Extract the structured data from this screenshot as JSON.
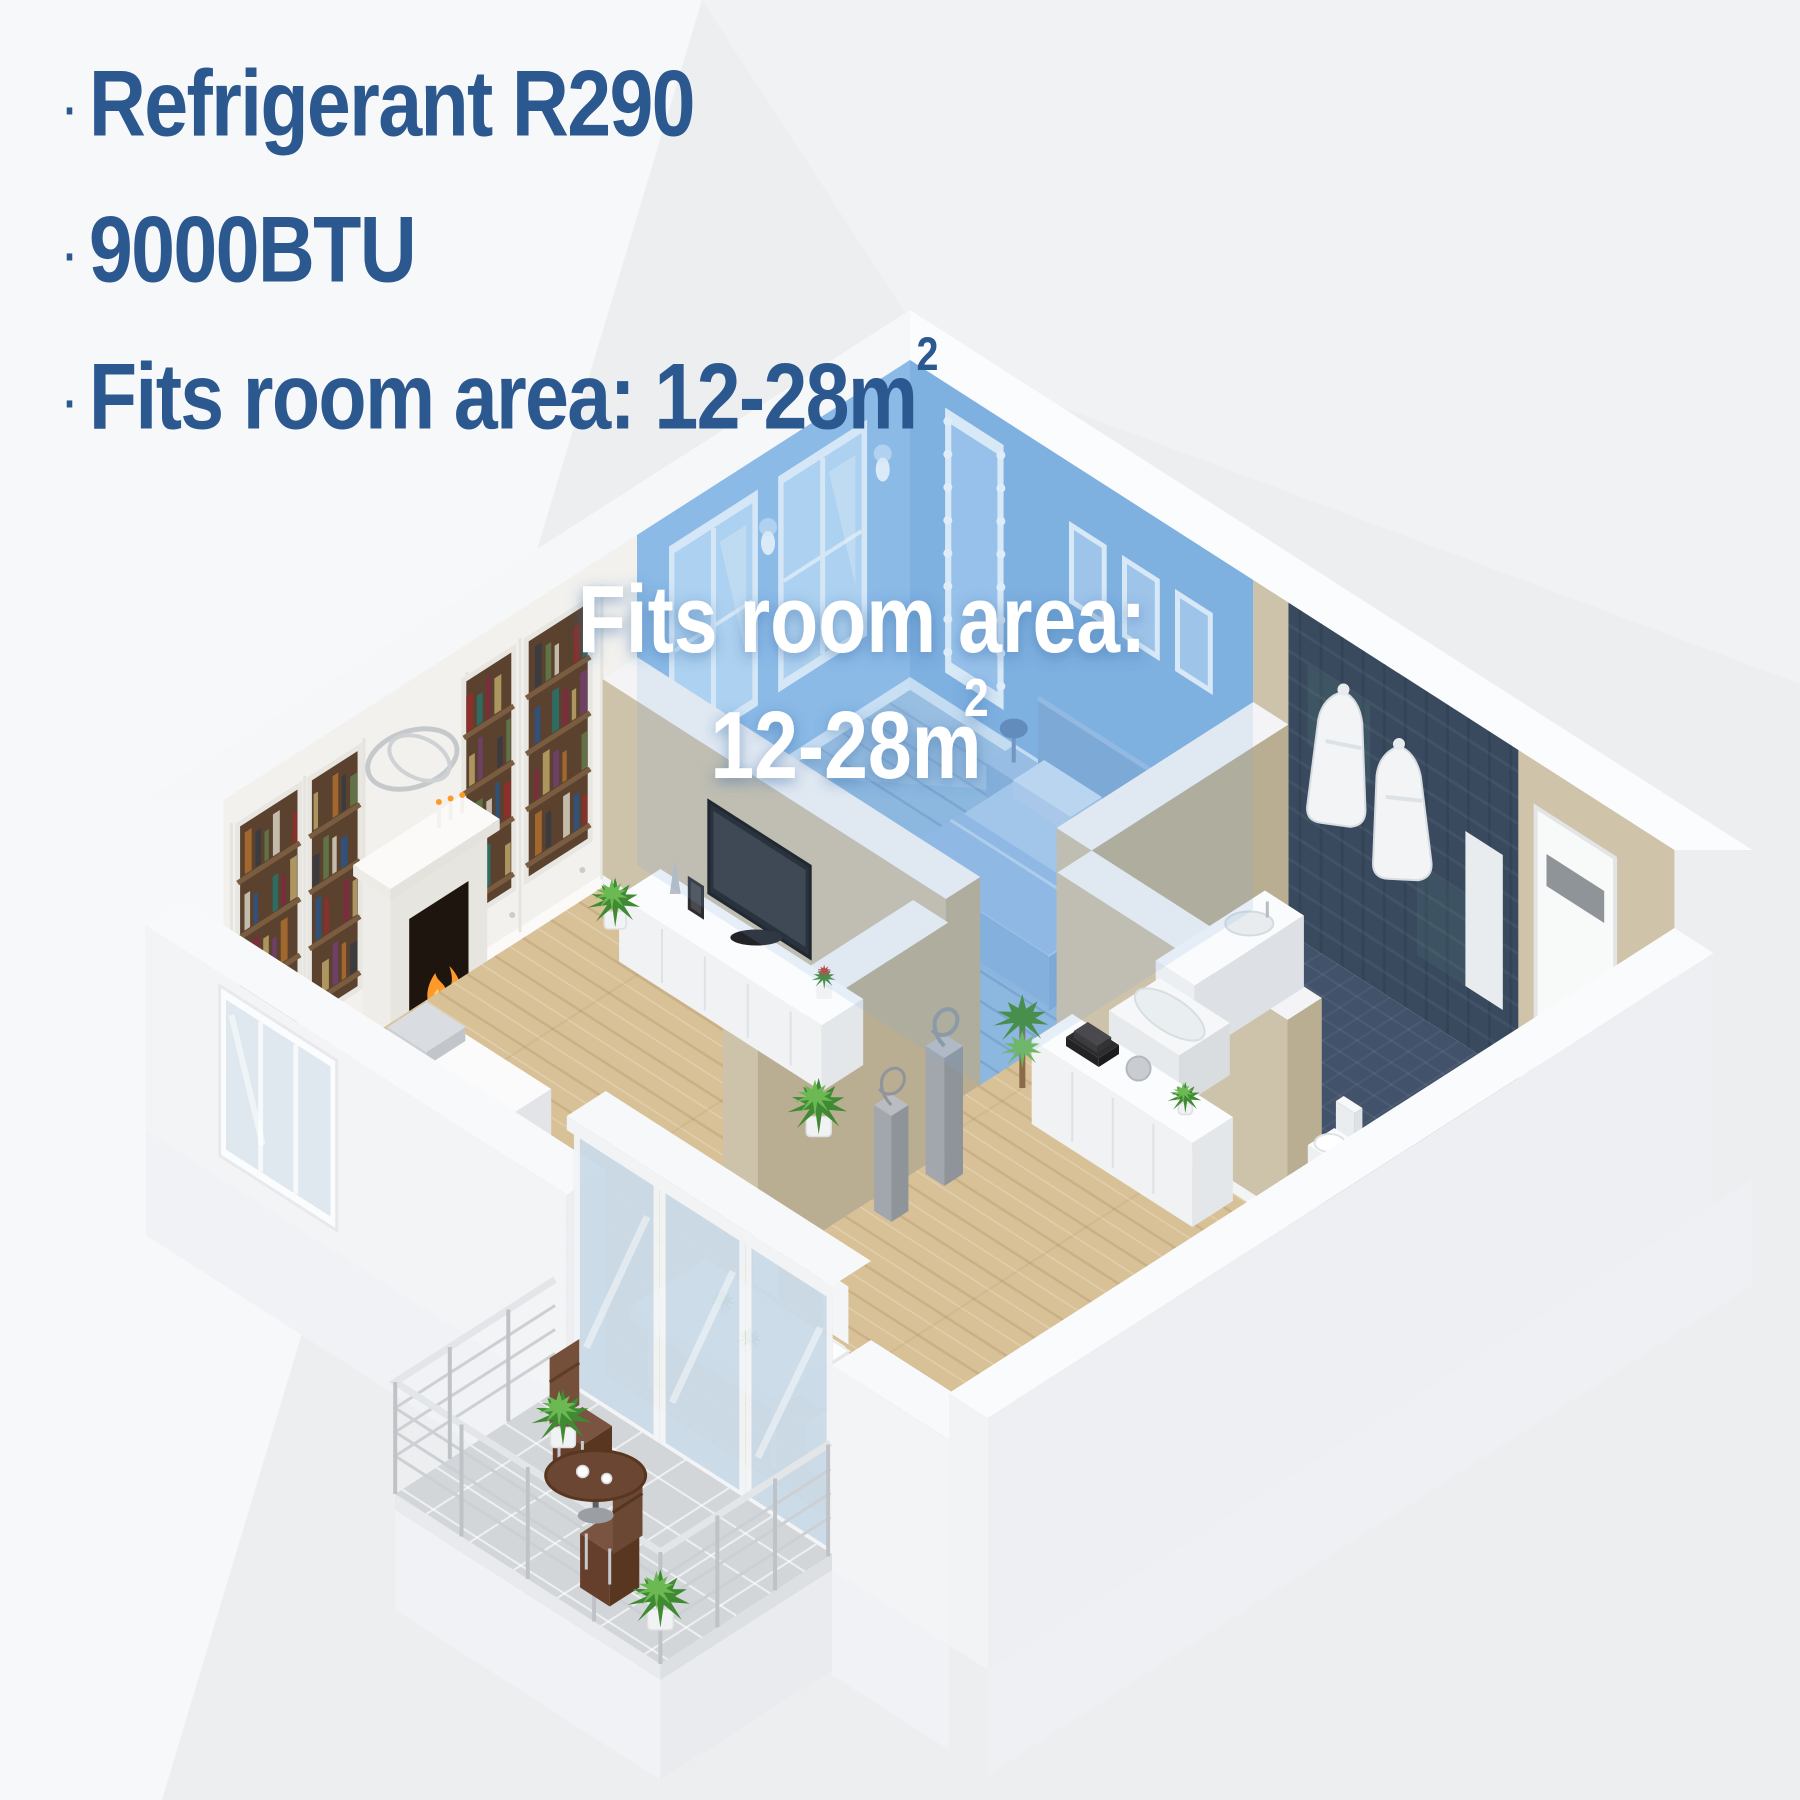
{
  "title_block": {
    "bullets": [
      {
        "marker": "·",
        "text": "Refrigerant R290",
        "sup": ""
      },
      {
        "marker": "·",
        "text": "9000BTU",
        "sup": ""
      },
      {
        "marker": "·",
        "text": "Fits room area: 12-28m",
        "sup": "2"
      }
    ]
  },
  "overlay": {
    "line1": "Fits room area:",
    "line2": "12-28m",
    "sup": "2"
  },
  "scene": {
    "highlighted_room": "bedroom",
    "rooms": [
      "bedroom",
      "living-room",
      "bathroom",
      "entry-hall",
      "dining-area",
      "balcony"
    ]
  },
  "theme": {
    "background": "#edeef0",
    "heading_color": "#2c5890",
    "overlay_text_color": "#ffffff",
    "highlight_blue": "#7fb0e0",
    "bedroom_wall_nw": "#8ebde9",
    "bedroom_wall_ne": "#7fb1e1",
    "bedroom_floor": "#8fb9df",
    "wood_floor": "#d8c197",
    "tan_wall": "#cdc2aa",
    "tan_wall_dark": "#b9ad92",
    "beige_wall": "#cfc3a9",
    "navy_tile": "#394a5f",
    "navy_floor": "#42526a",
    "white_wall": "#f6f7f9",
    "furniture_white": "#fbfbfc",
    "balcony_floor": "#d3d6d9",
    "wood_brown": "#6b4632",
    "plant_green": "#3f8a33",
    "plant_green_light": "#6cb954",
    "fire_orange": "#ff9a2a",
    "shelf_brown": "#5a422e"
  }
}
